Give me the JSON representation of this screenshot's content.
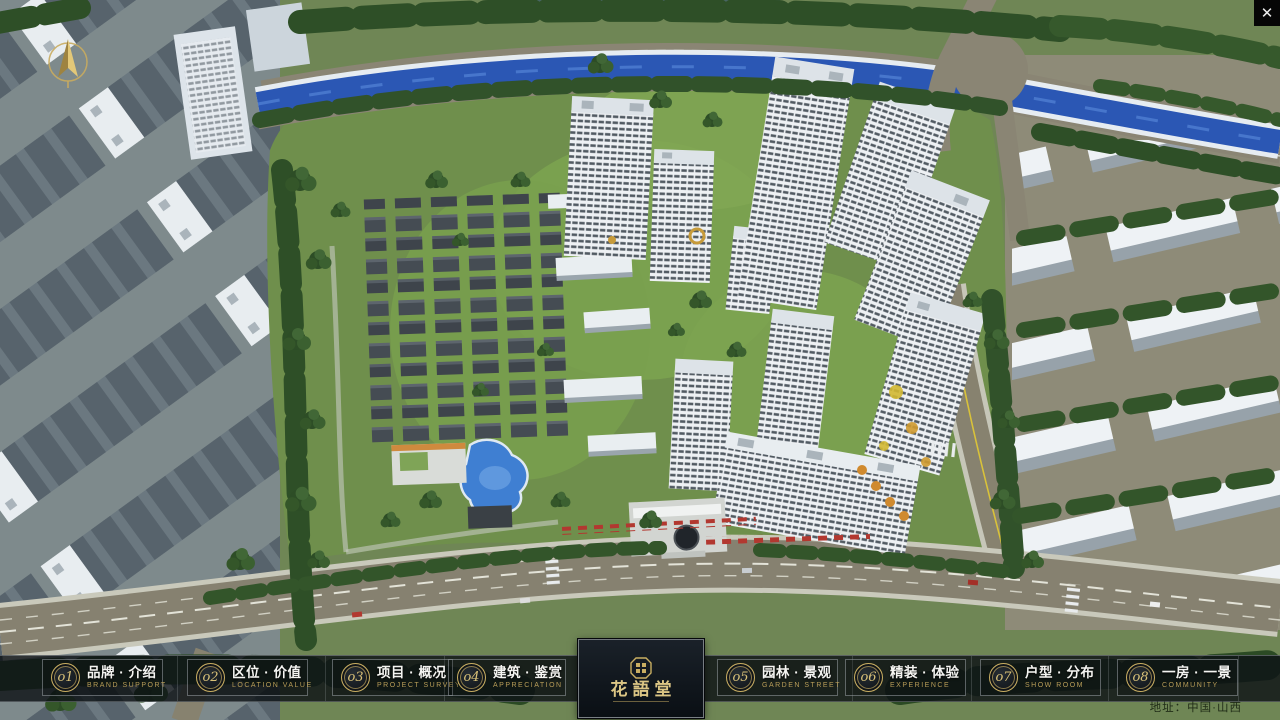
{
  "app": {
    "close_glyph": "✕"
  },
  "menu": {
    "items": [
      {
        "num": "o1",
        "zh": "品牌 · 介绍",
        "en": "BRAND SUPPORT"
      },
      {
        "num": "o2",
        "zh": "区位 · 价值",
        "en": "LOCATION VALUE"
      },
      {
        "num": "o3",
        "zh": "项目 · 概况",
        "en": "PROJECT SURVEY"
      },
      {
        "num": "o4",
        "zh": "建筑 · 鉴赏",
        "en": "APPRECIATION"
      },
      {
        "num": "o5",
        "zh": "园林 · 景观",
        "en": "GARDEN STREET"
      },
      {
        "num": "o6",
        "zh": "精装 · 体验",
        "en": "EXPERIENCE"
      },
      {
        "num": "o7",
        "zh": "户型 · 分布",
        "en": "SHOW ROOM"
      },
      {
        "num": "o8",
        "zh": "一房 · 一景",
        "en": "COMMUNITY"
      }
    ]
  },
  "logo": {
    "title": "花語堂"
  },
  "footer": {
    "address": "地址：中国·山西"
  },
  "colors": {
    "gold": "#c9ae62",
    "nav_bg": "rgba(14,18,22,0.82)",
    "river": "#2b57b4"
  }
}
